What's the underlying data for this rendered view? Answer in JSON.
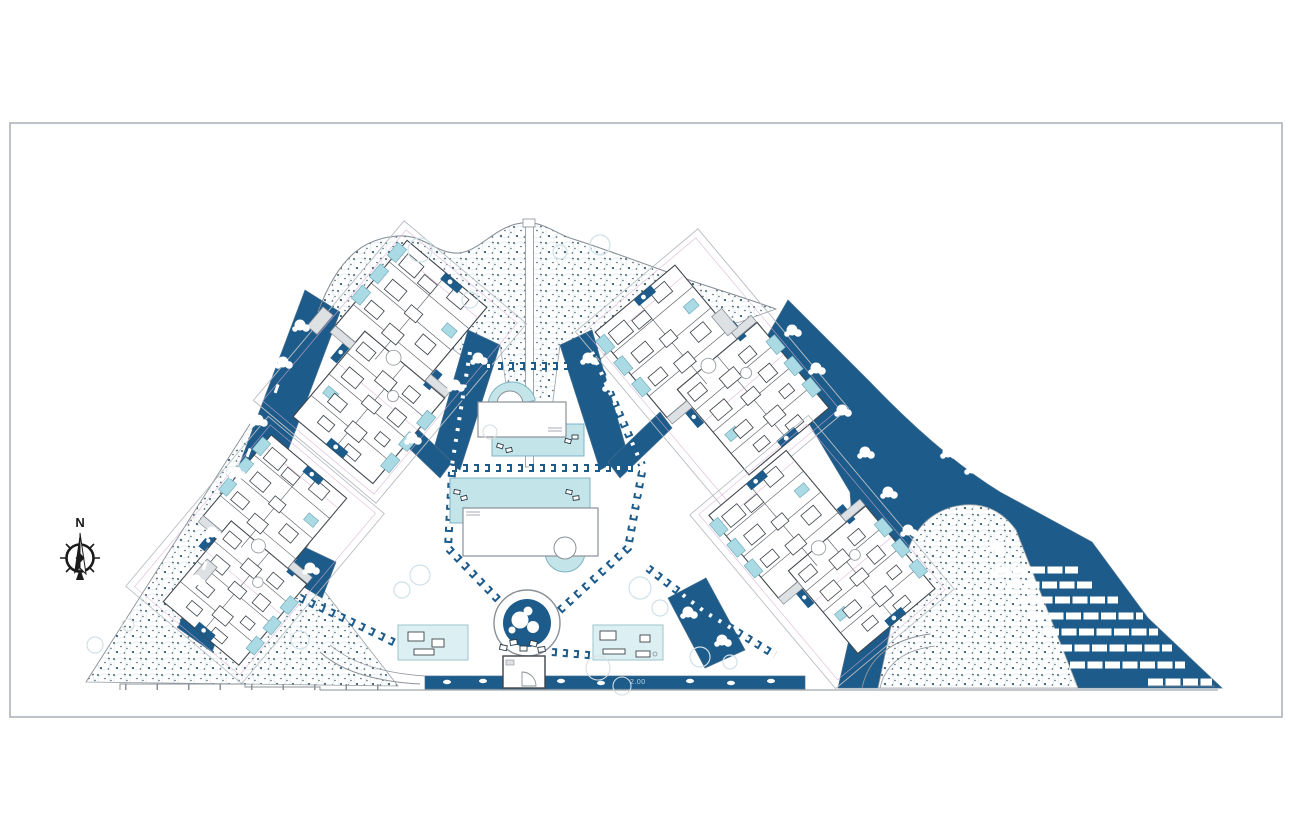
{
  "compass": {
    "label": "N"
  },
  "annotations": {
    "level_marker": "2.00"
  },
  "palette": {
    "deep_blue": "#1d5b8a",
    "pool_cyan": "#c3e5ea",
    "plunge_cyan": "#aadae4",
    "pale_cyan": "#dceff2",
    "stipple_speck": "#3f5d6b",
    "tree_outline": "#cfe1e9",
    "line_gray": "#8a9097",
    "dark_line": "#3f454b",
    "pink_line": "#d8aed0",
    "frame_gray": "#a9afb5"
  }
}
